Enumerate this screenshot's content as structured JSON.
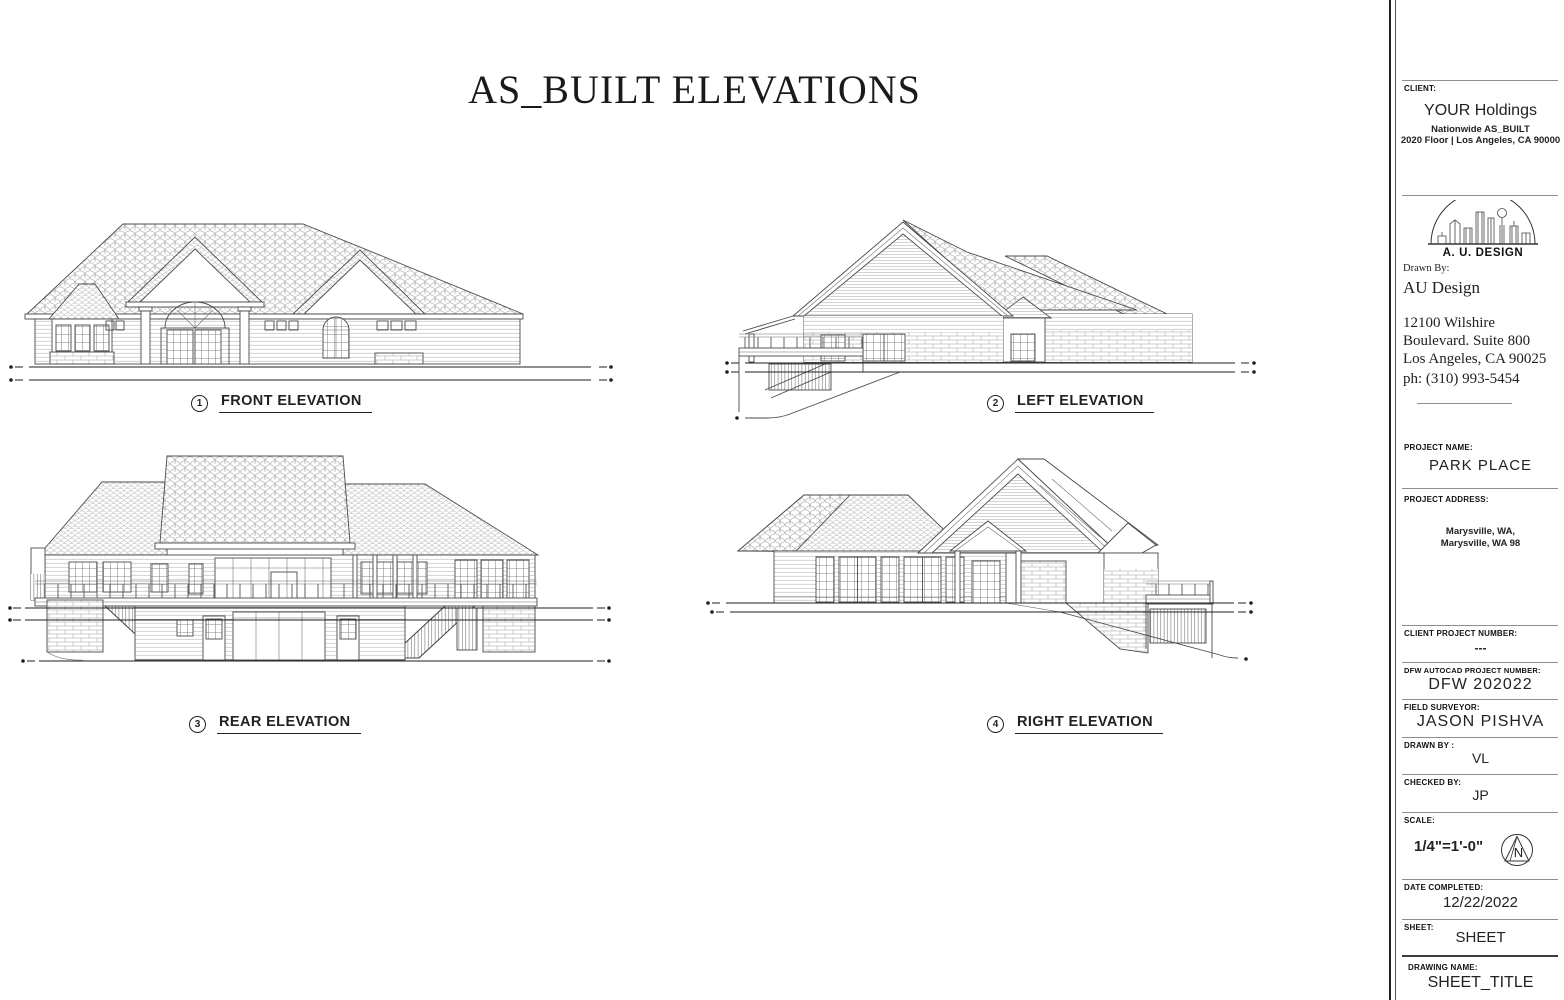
{
  "sheet": {
    "title": "AS_BUILT ELEVATIONS",
    "elevations": [
      {
        "number": "1",
        "label": "FRONT ELEVATION"
      },
      {
        "number": "2",
        "label": "LEFT ELEVATION"
      },
      {
        "number": "3",
        "label": "REAR ELEVATION"
      },
      {
        "number": "4",
        "label": "RIGHT ELEVATION"
      }
    ]
  },
  "title_block": {
    "client": {
      "label": "CLIENT:",
      "name": "YOUR Holdings",
      "line1": "Nationwide AS_BUILT",
      "line2": "2020 Floor | Los Angeles, CA 90000"
    },
    "logo": {
      "text": "A. U. DESIGN"
    },
    "firm": {
      "label": "Drawn By:",
      "name": "AU Design",
      "addr1": "12100 Wilshire",
      "addr2": "Boulevard. Suite 800",
      "addr3": "Los Angeles, CA 90025",
      "phone": "ph: (310) 993-5454"
    },
    "project_name": {
      "label": "PROJECT NAME:",
      "value": "PARK PLACE"
    },
    "project_address": {
      "label": "PROJECT ADDRESS:",
      "line1": "Marysville, WA,",
      "line2": "Marysville, WA 98"
    },
    "client_project_number": {
      "label": "CLIENT PROJECT NUMBER:",
      "value": "---"
    },
    "dfw_autocad_project_number": {
      "label": "DFW AUTOCAD PROJECT NUMBER:",
      "value": "DFW 202022"
    },
    "field_surveyor": {
      "label": "FIELD SURVEYOR:",
      "value": "JASON PISHVA"
    },
    "drawn_by": {
      "label": "DRAWN BY :",
      "value": "VL"
    },
    "checked_by": {
      "label": "CHECKED BY:",
      "value": "JP"
    },
    "scale": {
      "label": "SCALE:",
      "value": "1/4\"=1'-0\"",
      "north_letter": "N"
    },
    "date_completed": {
      "label": "DATE COMPLETED:",
      "value": "12/22/2022"
    },
    "sheet_field": {
      "label": "SHEET:",
      "value": "SHEET"
    },
    "drawing_name": {
      "label": "DRAWING NAME:",
      "value": "SHEET_TITLE"
    }
  }
}
